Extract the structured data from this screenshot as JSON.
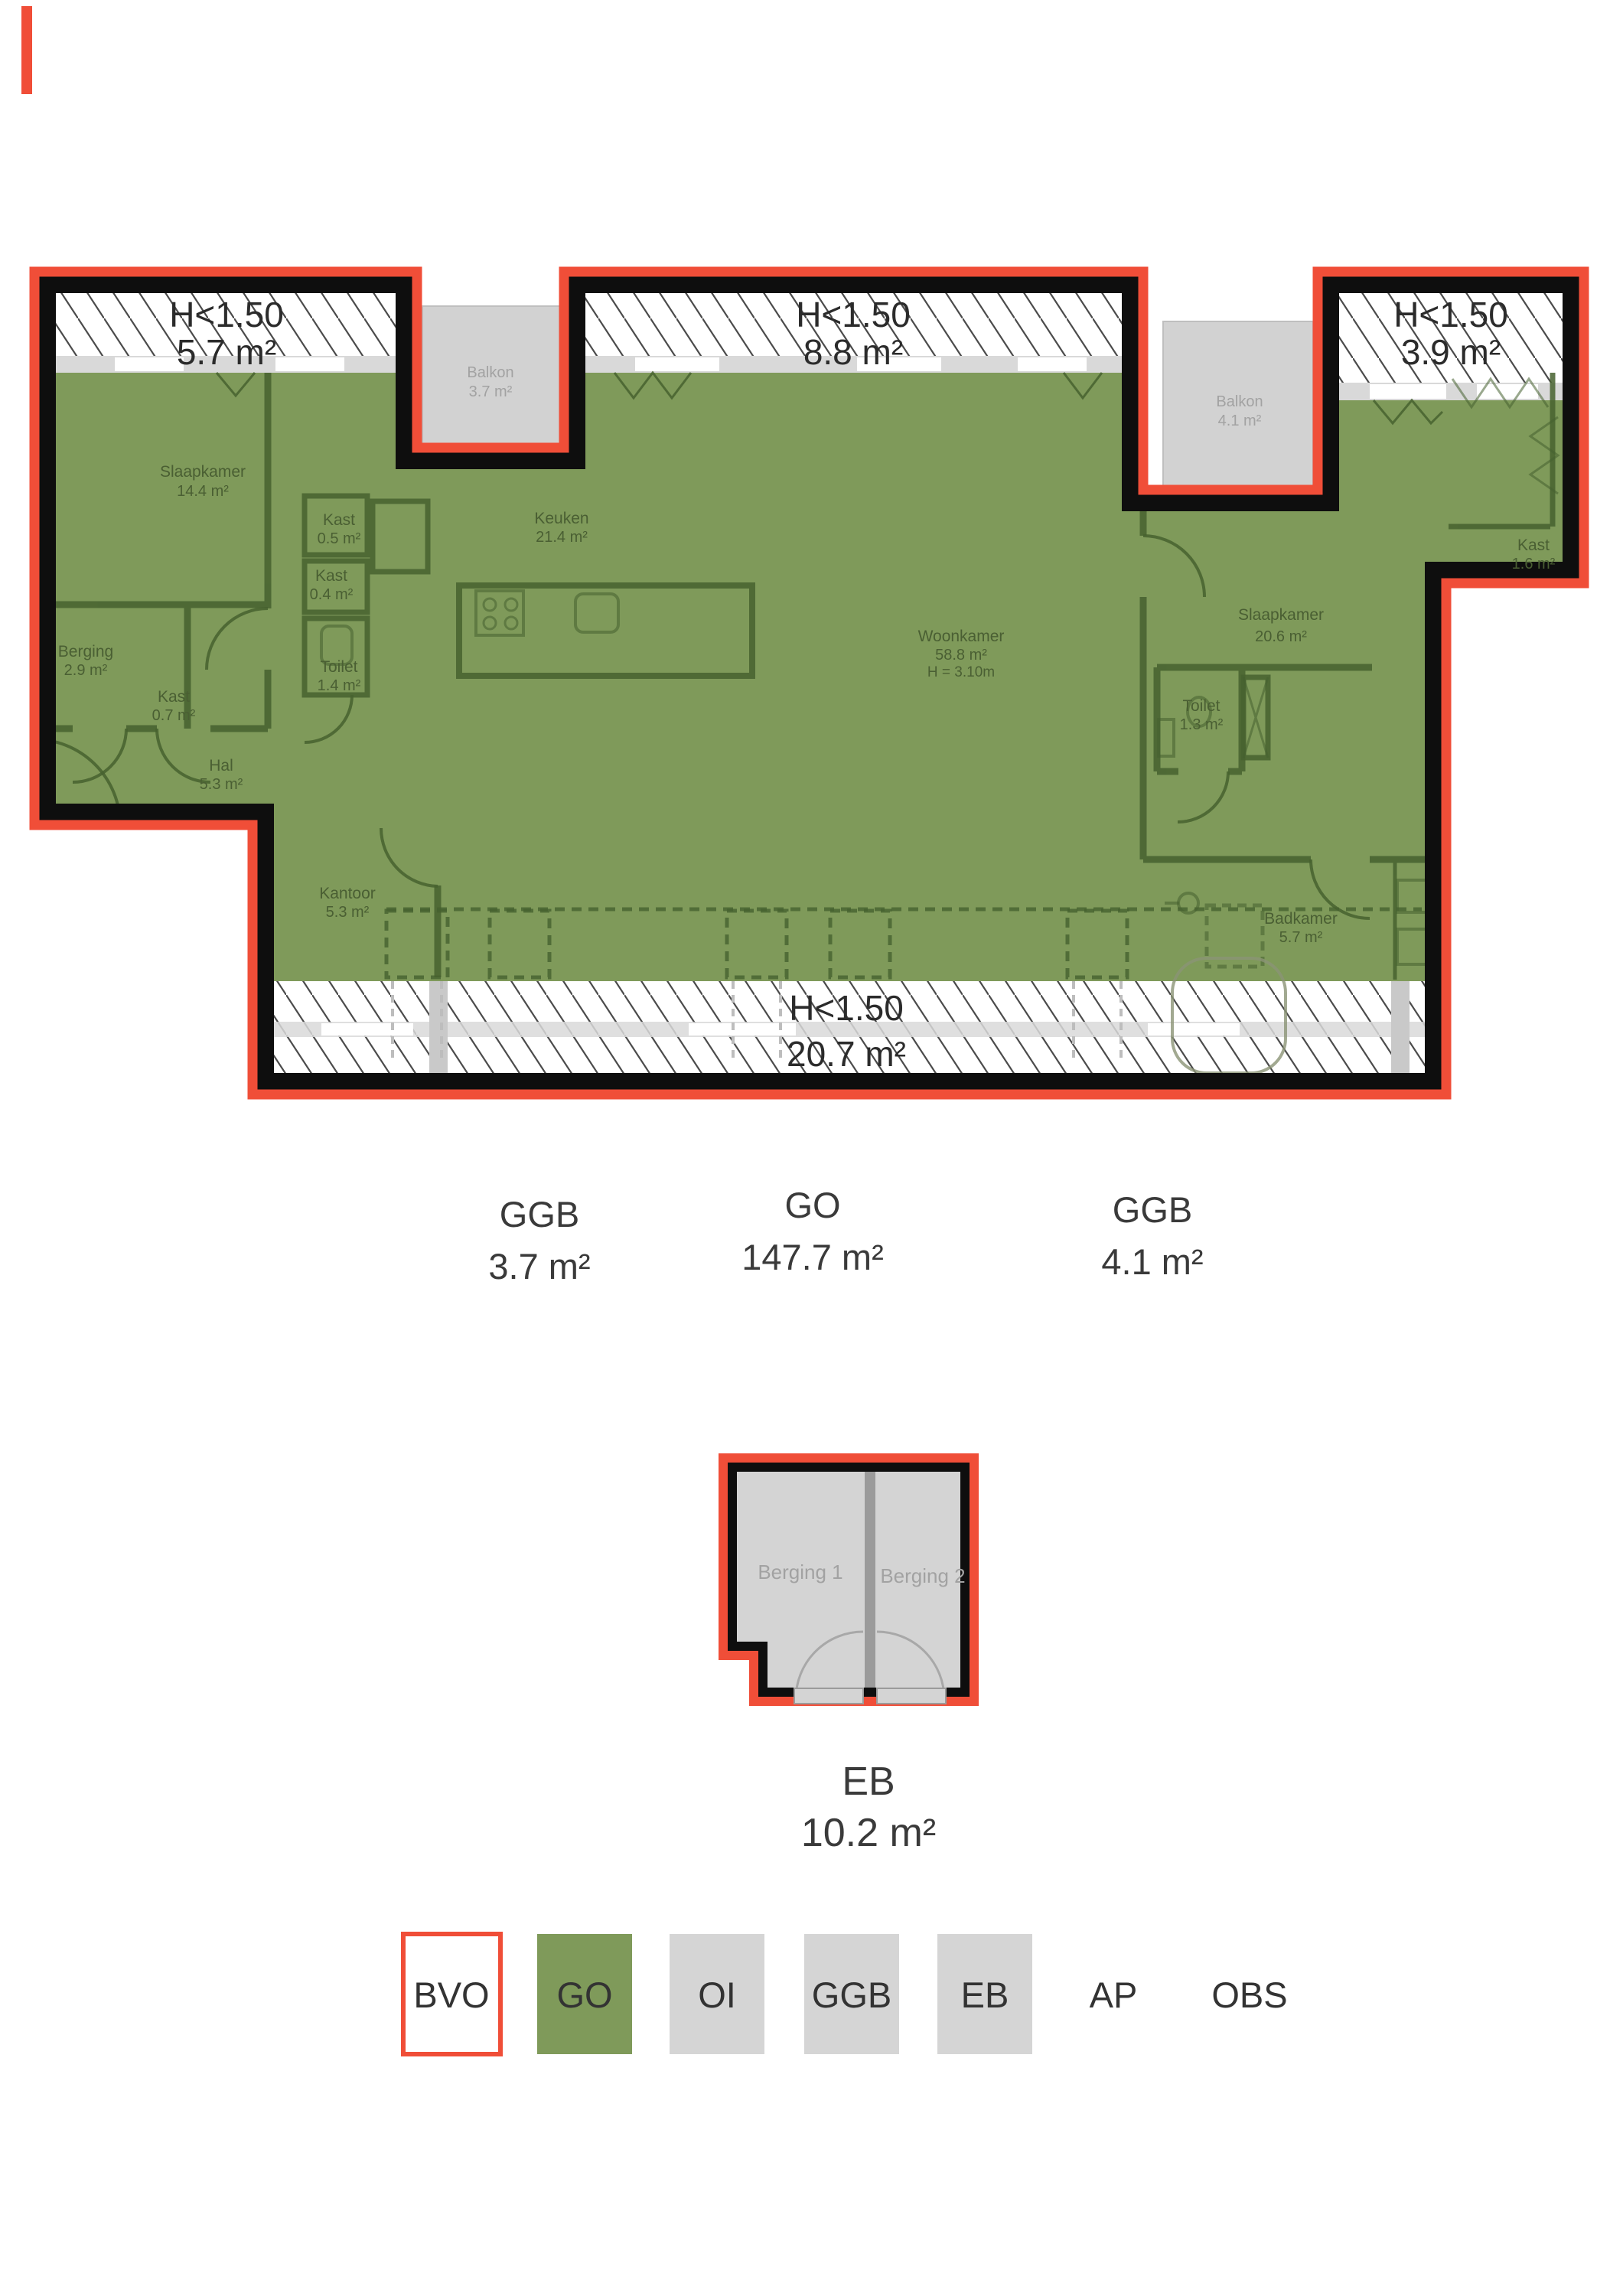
{
  "colors": {
    "outline_red": "#f04e38",
    "wall_black": "#0e0e0e",
    "go_green": "#7f9a5a",
    "room_line_green": "#46612f",
    "room_label_green": "#4a5f33",
    "balcony_gray": "#d2d2d2",
    "balcony_label_gray": "#a2a2a2",
    "sill_gray": "#d9d9d9",
    "label_dark": "#3a3a3a",
    "legend_gray": "#d5d5d5",
    "berging_divider": "#9b9b9b"
  },
  "main_plan": {
    "low_height_zones": [
      {
        "label": "H<1.50",
        "area": "5.7 m²"
      },
      {
        "label": "H<1.50",
        "area": "8.8 m²"
      },
      {
        "label": "H<1.50",
        "area": "3.9 m²"
      },
      {
        "label": "H<1.50",
        "area": "20.7 m²"
      }
    ],
    "balconies": [
      {
        "name": "Balkon",
        "area": "3.7 m²"
      },
      {
        "name": "Balkon",
        "area": "4.1 m²"
      }
    ],
    "rooms": [
      {
        "name": "Slaapkamer",
        "area": "14.4 m²"
      },
      {
        "name": "Kast",
        "area": "0.5 m²"
      },
      {
        "name": "Kast",
        "area": "0.4 m²"
      },
      {
        "name": "Toilet",
        "area": "1.4 m²"
      },
      {
        "name": "Berging",
        "area": "2.9 m²"
      },
      {
        "name": "Kast",
        "area": "0.7 m²"
      },
      {
        "name": "Hal",
        "area": "5.3 m²"
      },
      {
        "name": "Keuken",
        "area": "21.4 m²"
      },
      {
        "name": "Woonkamer",
        "area": "58.8 m²",
        "height": "H = 3.10m"
      },
      {
        "name": "Slaapkamer",
        "area": "20.6 m²"
      },
      {
        "name": "Kast",
        "area": "1.6 m²"
      },
      {
        "name": "Toilet",
        "area": "1.3 m²"
      },
      {
        "name": "Badkamer",
        "area": "5.7 m²"
      },
      {
        "name": "Kantoor",
        "area": "5.3 m²"
      }
    ],
    "area_summary": [
      {
        "code": "GGB",
        "area": "3.7 m²"
      },
      {
        "code": "GO",
        "area": "147.7 m²"
      },
      {
        "code": "GGB",
        "area": "4.1 m²"
      }
    ]
  },
  "storage_plan": {
    "units": [
      {
        "name": "Berging 1"
      },
      {
        "name": "Berging 2"
      }
    ],
    "summary": {
      "code": "EB",
      "area": "10.2 m²"
    }
  },
  "legend": {
    "items": [
      {
        "label": "BVO",
        "style": "outlined-red"
      },
      {
        "label": "GO",
        "style": "green"
      },
      {
        "label": "OI",
        "style": "gray"
      },
      {
        "label": "GGB",
        "style": "gray"
      },
      {
        "label": "EB",
        "style": "gray"
      },
      {
        "label": "AP",
        "style": "plain"
      },
      {
        "label": "OBS",
        "style": "plain"
      }
    ]
  }
}
